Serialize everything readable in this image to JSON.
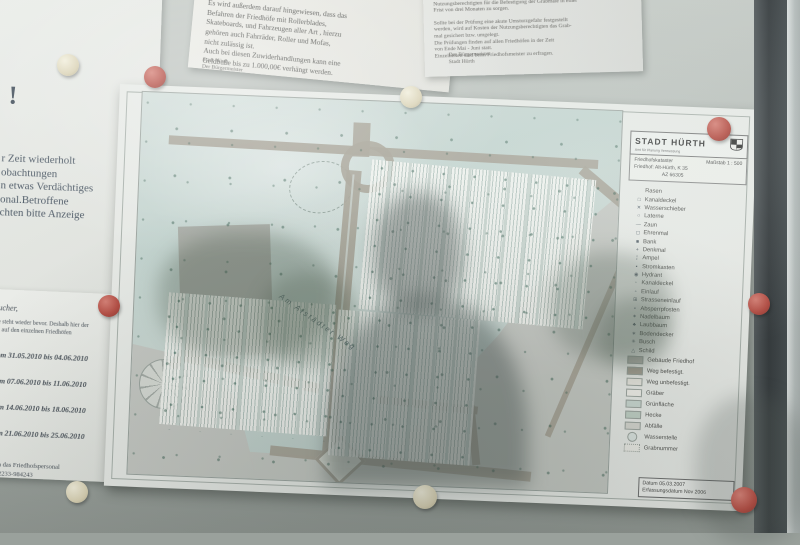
{
  "notices": {
    "fine": {
      "lines": [
        "Ordnungswidrigkeit mit einer Geldbuße bis",
        "1.000,00€ geahndet werden kann.",
        "",
        "Es wird außerdem darauf hingewiesen, dass das",
        "Befahren der Friedhöfe mit Rollerblades,",
        "Skateboards, und Fahrzeugen aller Art , hierzu",
        "gehören auch Fahrräder, Roller und Mofas,",
        "nicht zulässig ist.",
        "Auch bei diesen Zuwiderhandlungen kann eine",
        "Geldbuße bis zu 1.000,00€ verhängt werden."
      ],
      "sig1": "Stadt Hürth",
      "sig2": "Der Bürgermeister"
    },
    "inspection": {
      "lines": [
        "und Verwahrung kömt, im Falle einer Beanstandung, die",
        "Nutzungsberechtigten für die Befestigung der Grabmale in einer",
        "Frist von drei Monaten zu sorgen.",
        "",
        "Sollte bei der Prüfung eine akute Umsturzgefahr festgestellt",
        "werden, wird auf Kosten der Nutzungsberechtigten das Grab-",
        "mal gesichert bzw. umgelegt.",
        "Die Prüfungen finden auf allen Friedhöfen in der Zeit",
        "von Ende Mai - Juni statt.",
        "Einzelheiten sind beim Friedhofsmeister zu erfragen."
      ],
      "sig1": "Der Bürgermeister",
      "sig2": "Stadt Hürth"
    },
    "warning": {
      "mark": "!",
      "lines": [
        "r Zeit wiederholt",
        "obachtungen",
        "n etwas Verdächtiges",
        "onal.Betroffene",
        "chten bitte Anzeige"
      ]
    },
    "dates": {
      "salutation": "sucher,",
      "intro": [
        "lle steht wieder bevor. Deshalb hier der",
        "en auf den einzelnen Friedhöfen"
      ],
      "periods": [
        "vom 31.05.2010 bis 04.06.2010",
        "vom 07.06.2010 bis 11.06.2010",
        "vom 14.06.2010 bis 18.06.2010",
        "vom 21.06.2010 bis 25.06.2010"
      ],
      "footer": [
        "te an das Friedhofspersonal",
        "er 02233-984243"
      ]
    }
  },
  "map": {
    "agency": "STADT HÜRTH",
    "agency_sub": "Amt für Planung Vermessung",
    "doc_title": "Friedhofskataster",
    "scale": "Maßstab 1 : 500",
    "cemetery_line1": "Friedhof: Alt-Hürth, K 35",
    "cemetery_line2": "AZ 66305",
    "street_label": "Am Alstädter Weg",
    "legend_symbols": [
      {
        "sym": "",
        "label": "Rasen"
      },
      {
        "sym": "□",
        "label": "Kanaldeckel"
      },
      {
        "sym": "✕",
        "label": "Wasserschieber"
      },
      {
        "sym": "○",
        "label": "Laterne"
      },
      {
        "sym": "—",
        "label": "Zaun"
      },
      {
        "sym": "◻",
        "label": "Ehrenmal"
      },
      {
        "sym": "■",
        "label": "Bank"
      },
      {
        "sym": "+",
        "label": "Denkmal"
      },
      {
        "sym": "¦",
        "label": "Ampel"
      },
      {
        "sym": "▪",
        "label": "Stromkasten"
      },
      {
        "sym": "◉",
        "label": "Hydrant"
      },
      {
        "sym": "◦",
        "label": "Kanaldeckel"
      },
      {
        "sym": "▫",
        "label": "Einlauf"
      },
      {
        "sym": "⊞",
        "label": "Strasseneinlauf"
      },
      {
        "sym": "•",
        "label": "Absperrpfosten"
      },
      {
        "sym": "✶",
        "label": "Nadelbaum"
      },
      {
        "sym": "♣",
        "label": "Laubbaum"
      },
      {
        "sym": "∗",
        "label": "Bodendecker"
      },
      {
        "sym": "✳",
        "label": "Busch"
      },
      {
        "sym": "△",
        "label": "Schild"
      }
    ],
    "legend_areas": [
      {
        "label": "Gebäude Friedhof",
        "color": "#b3b3ac"
      },
      {
        "label": "Weg befestigt.",
        "color": "#a59f92"
      },
      {
        "label": "Weg unbefestigt.",
        "color": "#eceae2"
      },
      {
        "label": "Gräber",
        "color": "#f5f3ed"
      },
      {
        "label": "Grünfläche",
        "color": "#ccdad3"
      },
      {
        "label": "Hecke",
        "color": "#c2d2c6"
      },
      {
        "label": "Abfälle",
        "color": "#d9d9d2"
      },
      {
        "label": "Wasserstelle",
        "color": "#dfe7e3"
      },
      {
        "label": "Grabnummer",
        "color": "#f0efe9"
      }
    ],
    "footer_line1": "Datum 05.03.2007",
    "footer_line2": "Erfassungsdatum Nov 2006"
  },
  "colors": {
    "pin_red": "#b5443a",
    "pin_cream": "#e9e2c8",
    "road": "#a59f92",
    "green_area": "#c8d7d2",
    "board": "#a9b0ab",
    "frame": "#2c3134"
  }
}
